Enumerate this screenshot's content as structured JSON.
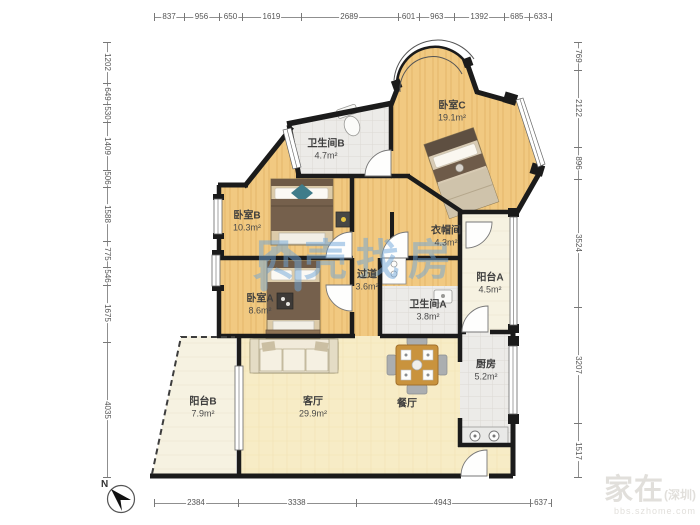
{
  "rooms": [
    {
      "id": "bedroomC",
      "name": "卧室C",
      "area": "19.1m²"
    },
    {
      "id": "bathroomB",
      "name": "卫生间B",
      "area": "4.7m²"
    },
    {
      "id": "bedroomB",
      "name": "卧室B",
      "area": "10.3m²"
    },
    {
      "id": "closet",
      "name": "衣帽间",
      "area": "4.3m²"
    },
    {
      "id": "hallway",
      "name": "过道",
      "area": "3.6m²"
    },
    {
      "id": "bedroomA",
      "name": "卧室A",
      "area": "8.6m²"
    },
    {
      "id": "bathroomA",
      "name": "卫生间A",
      "area": "3.8m²"
    },
    {
      "id": "balconyA",
      "name": "阳台A",
      "area": "4.5m²"
    },
    {
      "id": "kitchen",
      "name": "厨房",
      "area": "5.2m²"
    },
    {
      "id": "livingroom",
      "name": "客厅",
      "area": "29.9m²"
    },
    {
      "id": "diningroom",
      "name": "餐厅",
      "area": ""
    },
    {
      "id": "balconyB",
      "name": "阳台B",
      "area": "7.9m²"
    }
  ],
  "dimensions": {
    "top": [
      837,
      956,
      650,
      1619,
      2689,
      601,
      963,
      1392,
      685,
      633
    ],
    "left": [
      1202,
      649,
      530,
      1409,
      506,
      1588,
      775,
      546,
      1675,
      4035
    ],
    "right": [
      769,
      2122,
      896,
      3524,
      3207,
      1517
    ],
    "bottom": [
      2384,
      3338,
      4943,
      637
    ]
  },
  "compass": {
    "north_label": "N"
  },
  "watermark_center": {
    "brand": "贝壳找房"
  },
  "watermark_corner": {
    "big": "家在",
    "paren": "(深圳)",
    "sub": "bbs.szhome.com"
  },
  "colors": {
    "wall": "#1B1B1B",
    "wood_floor": "#F1C981",
    "tile_floor": "#ECEBE8",
    "living_floor": "#F7ECC6",
    "balcony_floor": "#F6F2E1",
    "watermark_blue": "#6FA6DA",
    "dimension_text": "#555555"
  }
}
